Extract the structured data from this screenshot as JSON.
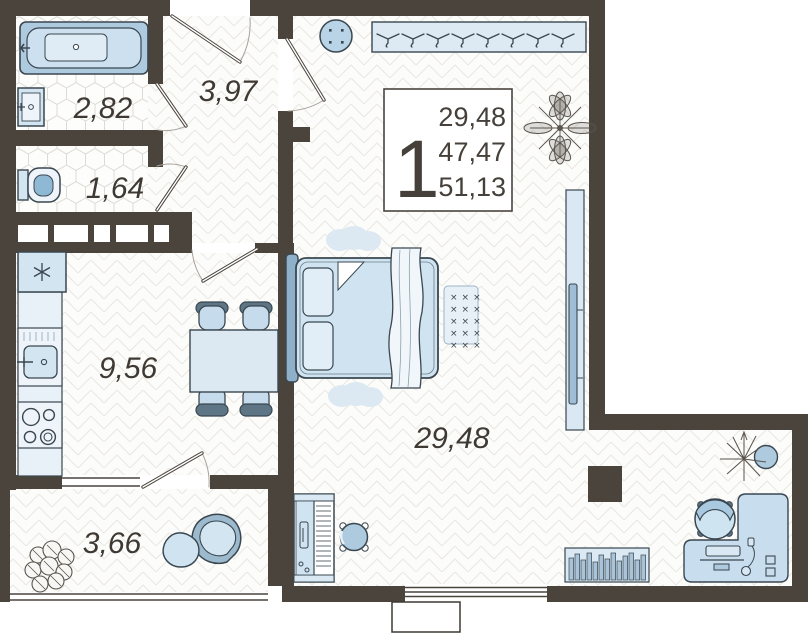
{
  "info_box": {
    "room_count": "1",
    "living_area": "29,48",
    "apartment_area": "47,47",
    "total_area": "51,13"
  },
  "room_labels": {
    "bathroom": "2,82",
    "hallway": "3,97",
    "wc": "1,64",
    "kitchen": "9,56",
    "living_room": "29,48",
    "loggia": "3,66"
  },
  "colors": {
    "wall": "#4a443d",
    "furniture_light": "#d3e5f1",
    "furniture_medium": "#aecade",
    "furniture_pale": "#e9f1f8",
    "outline": "#3a4750",
    "label_text": "#3f3933",
    "arc": "#a8a29a"
  }
}
